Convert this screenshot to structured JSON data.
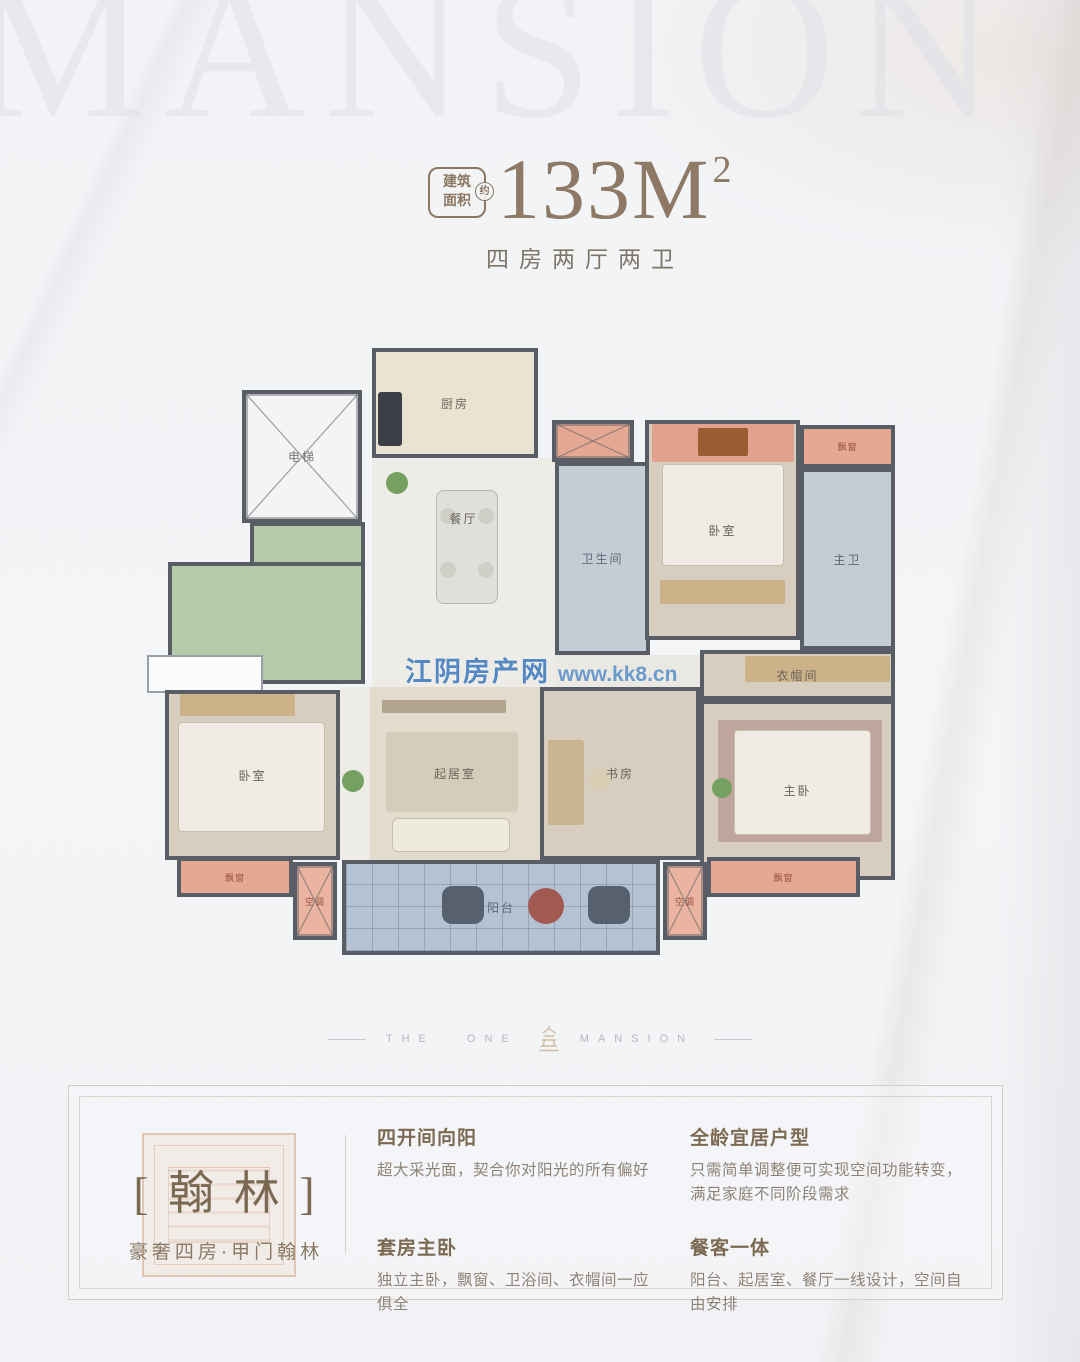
{
  "header": {
    "watermark": "MANSION",
    "badge_line1": "建筑",
    "badge_line2": "面积",
    "badge_approx": "约",
    "area_value": "133M",
    "area_sup": "2",
    "subtitle": "四房两厅两卫"
  },
  "floor_plan": {
    "watermark_site": "江阴房产网",
    "watermark_url": "www.kk8.cn",
    "rooms": [
      {
        "name": "green-terrace-upper",
        "label": "",
        "x": 160,
        "y": 182,
        "w": 115,
        "h": 44,
        "bg": "#b6caaa"
      },
      {
        "name": "green-terrace-lower",
        "label": "",
        "x": 78,
        "y": 222,
        "w": 197,
        "h": 122,
        "bg": "#b6caaa"
      },
      {
        "name": "west-window",
        "label": "",
        "x": 57,
        "y": 315,
        "w": 116,
        "h": 38,
        "bg": "#fbfbfc",
        "cls": "thin"
      },
      {
        "name": "elevator",
        "label": "电梯",
        "x": 152,
        "y": 50,
        "w": 120,
        "h": 133,
        "bg": "#f4f4f5",
        "cls": "xbox",
        "labelColor": "#76767c"
      },
      {
        "name": "kitchen",
        "label": "厨房",
        "x": 282,
        "y": 8,
        "w": 166,
        "h": 110,
        "bg": "#e9e4d1"
      },
      {
        "name": "dining",
        "label": "餐厅",
        "x": 282,
        "y": 118,
        "w": 183,
        "h": 120,
        "bg": "#edece6",
        "cls": "open"
      },
      {
        "name": "hallway",
        "label": "",
        "x": 282,
        "y": 238,
        "w": 183,
        "h": 109,
        "bg": "#edece6",
        "cls": "open"
      },
      {
        "name": "hallway-south",
        "label": "",
        "x": 250,
        "y": 347,
        "w": 32,
        "h": 173,
        "bg": "#edece6",
        "cls": "open"
      },
      {
        "name": "corridor",
        "label": "",
        "x": 465,
        "y": 315,
        "w": 155,
        "h": 45,
        "bg": "#e9e8e2",
        "cls": "open"
      },
      {
        "name": "ac-platform-north",
        "label": "",
        "x": 462,
        "y": 80,
        "w": 82,
        "h": 42,
        "bg": "#e5a892",
        "cls": "xbox"
      },
      {
        "name": "bathroom",
        "label": "卫生间",
        "x": 465,
        "y": 122,
        "w": 95,
        "h": 193,
        "bg": "#c3cdd6",
        "labelColor": "#5e6a76"
      },
      {
        "name": "bedroom-north",
        "label": "卧室",
        "x": 555,
        "y": 80,
        "w": 155,
        "h": 220,
        "bg": "#d8cec0"
      },
      {
        "name": "bay-window-ne",
        "label": "飘窗",
        "x": 710,
        "y": 85,
        "w": 95,
        "h": 43,
        "bg": "#e5a892",
        "labelColor": "#93503e",
        "small": true
      },
      {
        "name": "master-bathroom",
        "label": "主卫",
        "x": 710,
        "y": 128,
        "w": 95,
        "h": 182,
        "bg": "#c3cdd6",
        "labelColor": "#5e6a76"
      },
      {
        "name": "walk-in-closet",
        "label": "衣帽间",
        "x": 610,
        "y": 310,
        "w": 195,
        "h": 50,
        "bg": "#d8cec0"
      },
      {
        "name": "bedroom-southwest",
        "label": "卧室",
        "x": 75,
        "y": 350,
        "w": 175,
        "h": 170,
        "bg": "#d8cec0"
      },
      {
        "name": "living-room",
        "label": "起居室",
        "x": 280,
        "y": 347,
        "w": 170,
        "h": 173,
        "bg": "#e3dbcd",
        "cls": "open"
      },
      {
        "name": "study",
        "label": "书房",
        "x": 450,
        "y": 347,
        "w": 160,
        "h": 173,
        "bg": "#d8cec0"
      },
      {
        "name": "master-bedroom",
        "label": "主卧",
        "x": 610,
        "y": 360,
        "w": 195,
        "h": 180,
        "bg": "#d8cec0"
      },
      {
        "name": "balcony",
        "label": "阳台",
        "x": 252,
        "y": 520,
        "w": 318,
        "h": 95,
        "bg": "#b4c2d4",
        "cls": "grid",
        "labelColor": "#5d6b7c"
      },
      {
        "name": "ac-platform-west",
        "label": "空调",
        "x": 203,
        "y": 522,
        "w": 44,
        "h": 78,
        "bg": "#eab4a0",
        "cls": "xbox",
        "labelColor": "#93503e",
        "small": true
      },
      {
        "name": "ac-platform-east",
        "label": "空调",
        "x": 573,
        "y": 522,
        "w": 44,
        "h": 78,
        "bg": "#eab4a0",
        "cls": "xbox",
        "labelColor": "#93503e",
        "small": true
      },
      {
        "name": "bay-window-sw",
        "label": "飘窗",
        "x": 87,
        "y": 517,
        "w": 116,
        "h": 40,
        "bg": "#e5a892",
        "labelColor": "#93503e",
        "small": true
      },
      {
        "name": "bay-window-se",
        "label": "飘窗",
        "x": 617,
        "y": 517,
        "w": 153,
        "h": 40,
        "bg": "#e5a892",
        "labelColor": "#93503e",
        "small": true
      }
    ],
    "furniture": [
      {
        "name": "stove",
        "shape": "rect",
        "x": 288,
        "y": 52,
        "w": 24,
        "h": 54,
        "bg": "#3b4046",
        "r": 3
      },
      {
        "name": "dining-table",
        "shape": "rect",
        "x": 346,
        "y": 150,
        "w": 60,
        "h": 112,
        "bg": "#e0e0da",
        "r": 8,
        "border": "#b6b6ae"
      },
      {
        "name": "dining-chair",
        "shape": "circle",
        "x": 350,
        "y": 168,
        "d": 16,
        "bg": "#cfcfc7"
      },
      {
        "name": "dining-chair",
        "shape": "circle",
        "x": 388,
        "y": 168,
        "d": 16,
        "bg": "#cfcfc7"
      },
      {
        "name": "dining-chair",
        "shape": "circle",
        "x": 350,
        "y": 222,
        "d": 16,
        "bg": "#cfcfc7"
      },
      {
        "name": "dining-chair",
        "shape": "circle",
        "x": 388,
        "y": 222,
        "d": 16,
        "bg": "#cfcfc7"
      },
      {
        "name": "bay-cushions",
        "shape": "rect",
        "x": 562,
        "y": 84,
        "w": 142,
        "h": 38,
        "bg": "#e0a18e",
        "r": 2
      },
      {
        "name": "bay-dresser",
        "shape": "rect",
        "x": 608,
        "y": 88,
        "w": 50,
        "h": 28,
        "bg": "#9c5c33",
        "r": 2
      },
      {
        "name": "bed-north",
        "shape": "rect",
        "x": 572,
        "y": 124,
        "w": 120,
        "h": 100,
        "bg": "#f0ece3",
        "r": 4,
        "border": "#c6beae"
      },
      {
        "name": "wardrobe-north",
        "shape": "rect",
        "x": 570,
        "y": 240,
        "w": 125,
        "h": 24,
        "bg": "#cdb289",
        "r": 2
      },
      {
        "name": "wardrobe-sw",
        "shape": "rect",
        "x": 90,
        "y": 354,
        "w": 115,
        "h": 22,
        "bg": "#cdb289",
        "r": 2
      },
      {
        "name": "bed-southwest",
        "shape": "rect",
        "x": 88,
        "y": 382,
        "w": 145,
        "h": 108,
        "bg": "#f0ece3",
        "r": 4,
        "border": "#c6beae"
      },
      {
        "name": "tv-cabinet",
        "shape": "rect",
        "x": 292,
        "y": 360,
        "w": 124,
        "h": 13,
        "bg": "#b3a58d",
        "r": 2
      },
      {
        "name": "living-rug",
        "shape": "rect",
        "x": 296,
        "y": 392,
        "w": 132,
        "h": 80,
        "bg": "#d6ccba",
        "r": 4
      },
      {
        "name": "sofa",
        "shape": "rect",
        "x": 302,
        "y": 478,
        "w": 116,
        "h": 32,
        "bg": "#efeade",
        "r": 6,
        "border": "#c6beae"
      },
      {
        "name": "desk",
        "shape": "rect",
        "x": 458,
        "y": 400,
        "w": 36,
        "h": 85,
        "bg": "#c8b48e",
        "r": 3
      },
      {
        "name": "desk-chair",
        "shape": "circle",
        "x": 498,
        "y": 428,
        "d": 22,
        "bg": "#d9cdb4"
      },
      {
        "name": "closet-wardrobe",
        "shape": "rect",
        "x": 655,
        "y": 316,
        "w": 145,
        "h": 26,
        "bg": "#cdb289",
        "r": 2
      },
      {
        "name": "master-rug",
        "shape": "rect",
        "x": 628,
        "y": 380,
        "w": 164,
        "h": 122,
        "bg": "#c0a59c",
        "r": 2
      },
      {
        "name": "bed-master",
        "shape": "rect",
        "x": 644,
        "y": 390,
        "w": 135,
        "h": 103,
        "bg": "#f0ece3",
        "r": 4,
        "border": "#c6beae"
      },
      {
        "name": "balcony-chair",
        "shape": "rect",
        "x": 352,
        "y": 546,
        "w": 42,
        "h": 38,
        "bg": "#57616d",
        "r": 10
      },
      {
        "name": "balcony-chair",
        "shape": "rect",
        "x": 498,
        "y": 546,
        "w": 42,
        "h": 38,
        "bg": "#57616d",
        "r": 10
      },
      {
        "name": "balcony-table",
        "shape": "circle",
        "x": 438,
        "y": 548,
        "d": 36,
        "bg": "#a15a51"
      },
      {
        "name": "plant",
        "shape": "circle",
        "x": 296,
        "y": 132,
        "d": 22,
        "bg": "#74a061"
      },
      {
        "name": "plant",
        "shape": "circle",
        "x": 252,
        "y": 430,
        "d": 22,
        "bg": "#74a061"
      },
      {
        "name": "plant",
        "shape": "circle",
        "x": 622,
        "y": 438,
        "d": 20,
        "bg": "#74a061"
      }
    ]
  },
  "divider": {
    "left": "THE ONE",
    "right": "MANSION"
  },
  "info": {
    "name_display": "[ 翰 林 ]",
    "tagline": "豪奢四房·甲门翰林",
    "features": [
      {
        "title": "四开间向阳",
        "desc": "超大采光面，契合你对阳光的所有偏好"
      },
      {
        "title": "套房主卧",
        "desc": "独立主卧，飘窗、卫浴间、衣帽间一应俱全"
      },
      {
        "title": "全龄宜居户型",
        "desc": "只需简单调整便可实现空间功能转变，满足家庭不同阶段需求"
      },
      {
        "title": "餐客一体",
        "desc": "阳台、起居室、餐厅一线设计，空间自由安排"
      }
    ]
  },
  "colors": {
    "accent_brown": "#8c7862",
    "wall": "#595e66",
    "bay_pink": "#e5a892",
    "terrace_green": "#b6caaa",
    "balcony_blue": "#b4c2d4",
    "watermark_blue": "#3876bc"
  }
}
